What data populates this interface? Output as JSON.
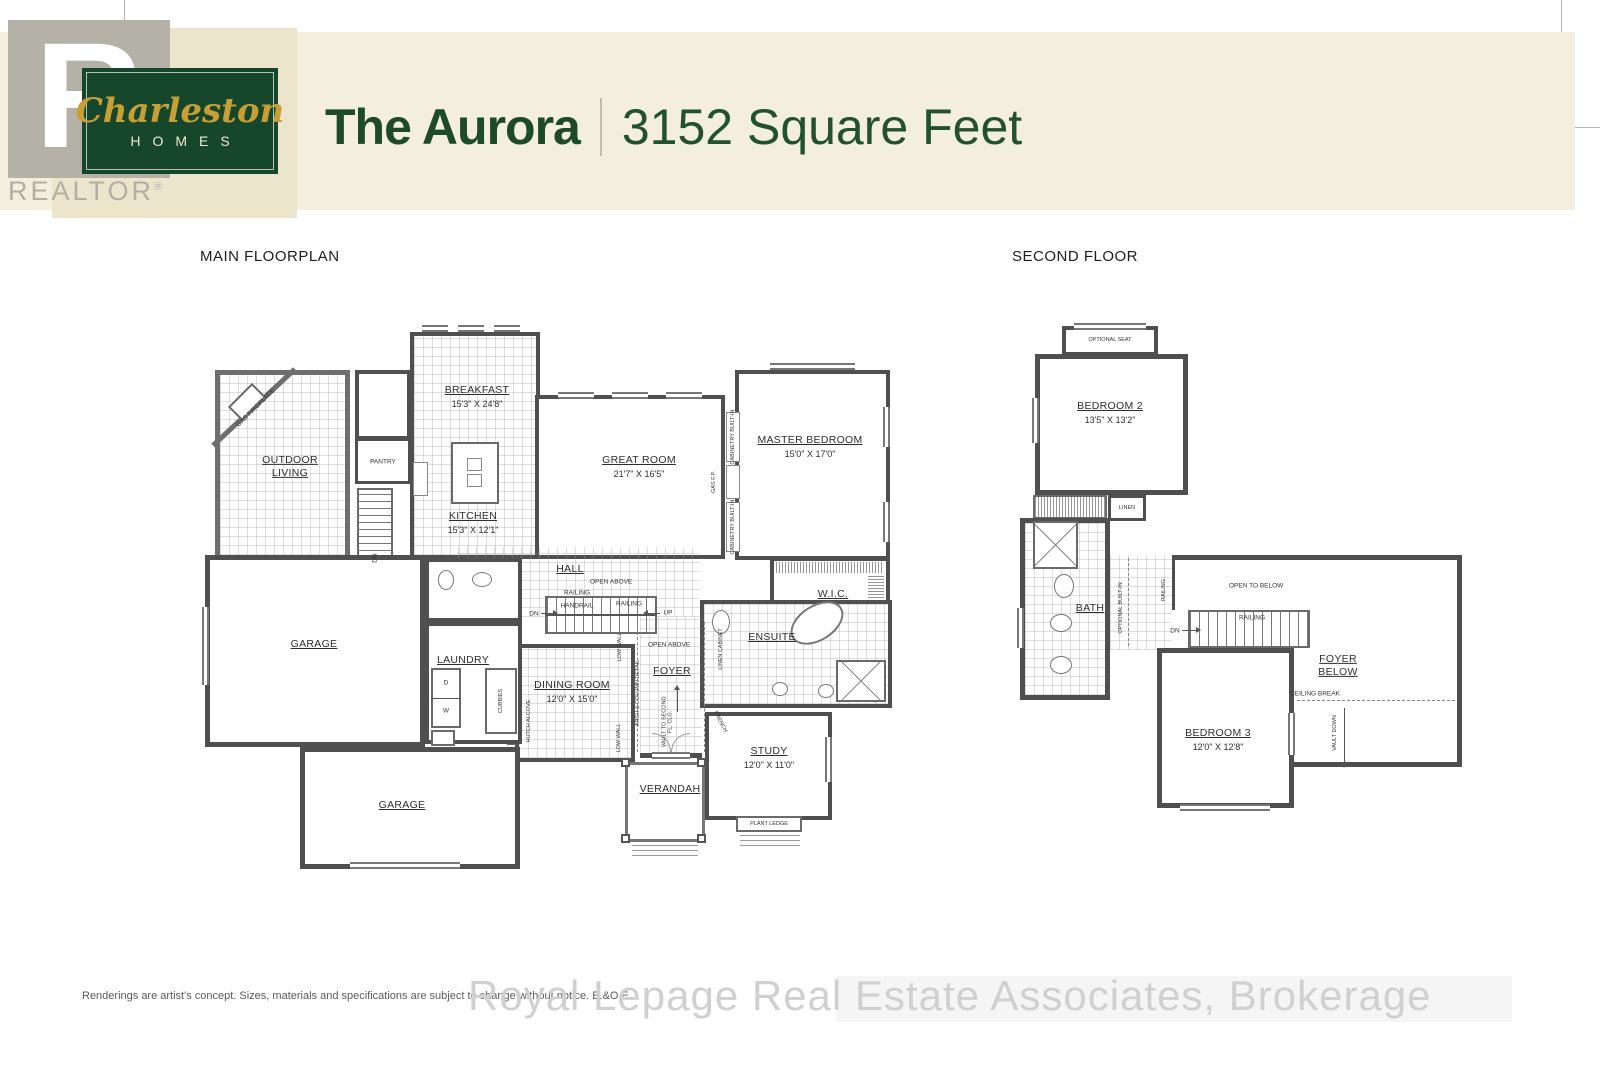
{
  "header": {
    "brand_r": "R",
    "brand_script": "Charleston",
    "brand_word": "HOMES",
    "realtor": "REALTOR",
    "realtor_reg": "®",
    "title": "The Aurora",
    "subtitle": "3152 Square Feet"
  },
  "main": {
    "heading": "MAIN FLOORPLAN",
    "outdoor_living": "OUTDOOR LIVING",
    "gas_fireplace": "GAS FIREPLACE",
    "pantry": "PANTRY",
    "breakfast": "BREAKFAST",
    "breakfast_dims": "15'3\" X 24'8\"",
    "kitchen": "KITCHEN",
    "kitchen_dims": "15'3\" X 12'1\"",
    "great_room": "GREAT ROOM",
    "great_room_dims": "21'7\" X 16'5\"",
    "cabinetry_built_in": "CABINETRY BUILT-IN",
    "gas_fp": "GAS F.P.",
    "master_bedroom": "MASTER BEDROOM",
    "master_bedroom_dims": "15'0\" X 17'0\"",
    "wic": "W.I.C.",
    "hall": "HALL",
    "open_above": "OPEN ABOVE",
    "railing": "RAILING",
    "handrail": "HANDRAIL",
    "dn": "DN",
    "up": "UP",
    "garage": "GARAGE",
    "laundry": "LAUNDRY",
    "cubbies": "CUBBIES",
    "dryer": "D",
    "washer": "W",
    "dining_room": "DINING ROOM",
    "dining_room_dims": "12'0\" X 15'0\"",
    "hutch_alcove": "HUTCH ALCOVE",
    "low_wall": "LOW WALL",
    "arch_column": "ARCH & COLUMN DETAIL",
    "foyer": "FOYER",
    "vault_to": "VAULT TO SECOND FL. CLG.",
    "linen_cabinet": "LINEN CABINET",
    "ensuite": "ENSUITE",
    "french": "FRENCH",
    "study": "STUDY",
    "study_dims": "12'0\" X 11'0\"",
    "verandah": "VERANDAH",
    "plant_ledge": "PLANT LEDGE"
  },
  "second": {
    "heading": "SECOND FLOOR",
    "optional_seat": "OPTIONAL SEAT",
    "bedroom2": "BEDROOM 2",
    "bedroom2_dims": "13'5\" X 13'2\"",
    "linen": "LINEN",
    "bath": "BATH",
    "optional_built_in": "OPTIONAL BUILT-IN",
    "railing": "RAILING",
    "open_to_below": "OPEN TO BELOW",
    "dn": "DN",
    "foyer_below": "FOYER BELOW",
    "ceiling_break": "CEILING BREAK",
    "vault_down": "VAULT DOWN",
    "bedroom3": "BEDROOM 3",
    "bedroom3_dims": "12'0\" X 12'8\""
  },
  "footer": {
    "disclaimer": "Renderings are artist's concept. Sizes, materials and specifications are subject to change without notice. E.&O.E.",
    "watermark": "Royal Lepage Real Estate Associates, Brokerage"
  }
}
